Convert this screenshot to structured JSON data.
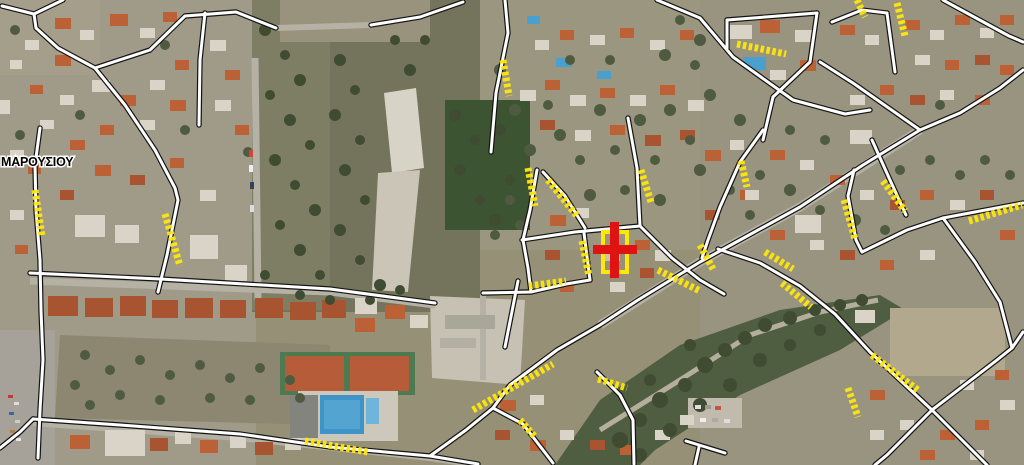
{
  "map": {
    "type": "aerial-orthophoto",
    "place_label": "ΜΑΡΟΥΣΙΟΥ",
    "marker": {
      "name": "selected-parcel-cross",
      "color": "#e01313",
      "parcel_outline_color": "#ffe70a"
    },
    "overlays": {
      "road_color": "#ffffff",
      "road_casing_color": "#141414",
      "highlight_color": "#ffe70a",
      "highlight_style": "dashed"
    }
  }
}
